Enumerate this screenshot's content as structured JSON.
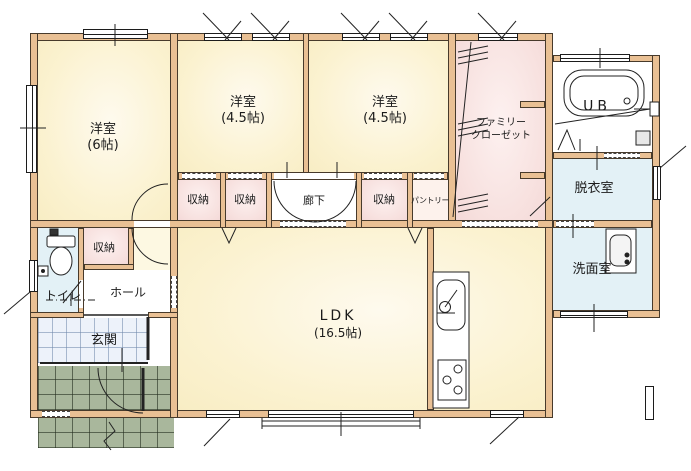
{
  "plan_title": "1F floor plan",
  "rooms": {
    "western6": {
      "name": "洋室",
      "size": "(6帖)"
    },
    "western45_left": {
      "name": "洋室",
      "size": "(4.5帖)"
    },
    "western45_right": {
      "name": "洋室",
      "size": "(4.5帖)"
    },
    "family_closet": {
      "name_line1": "ファミリー",
      "name_line2": "クローゼット"
    },
    "unit_bath": {
      "name": "UB"
    },
    "dressing_room": {
      "name": "脱衣室"
    },
    "washroom": {
      "name": "洗面室"
    },
    "toilet": {
      "name": "トイレ"
    },
    "hall": {
      "name": "ホール"
    },
    "entrance": {
      "name": "玄関"
    },
    "corridor": {
      "name": "廊下"
    },
    "pantry": {
      "name": "パントリー"
    },
    "storage_1": {
      "name": "収納"
    },
    "storage_2": {
      "name": "収納"
    },
    "storage_3": {
      "name": "収納"
    },
    "storage_hall": {
      "name": "収納"
    },
    "ldk": {
      "name": "LDK",
      "size": "(16.5帖)"
    }
  },
  "colors": {
    "wall_fill": "#e9c094",
    "outline": "#473a2b",
    "room_floor_yellow": "#fbf2d0",
    "closet_pink": "#f7e0de",
    "water_area_blue": "#e3f1f6",
    "entrance_tile": "#edf2fa",
    "porch_green": "#a9b79c"
  }
}
